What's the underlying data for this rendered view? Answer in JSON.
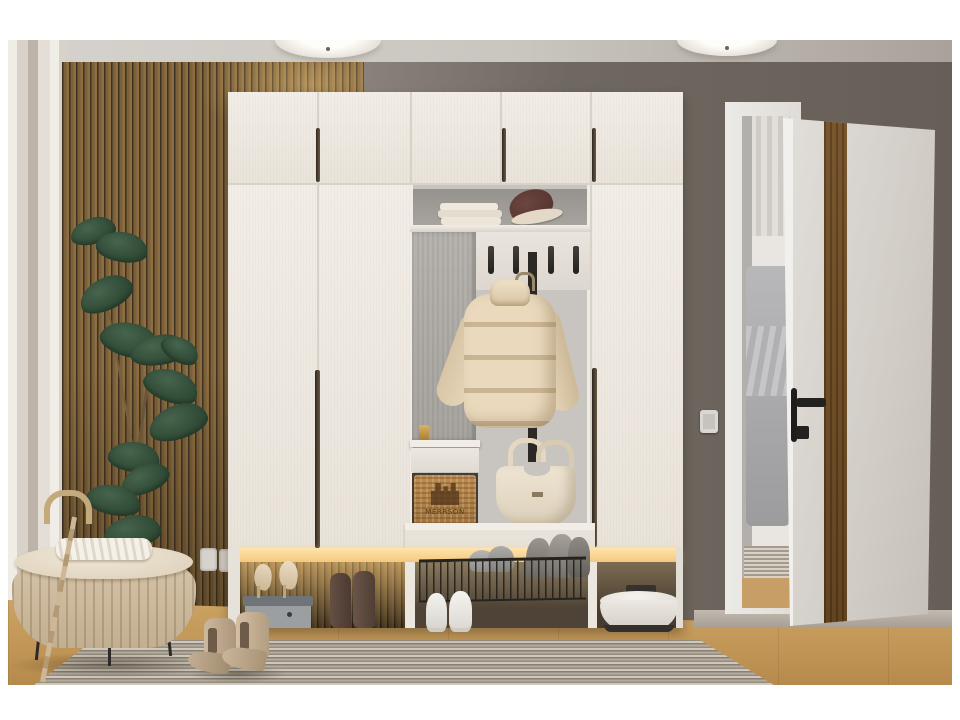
{
  "meta": {
    "title": "Hallway interior photo — white wardrobe entry unit",
    "scene_type": "interior product photograph",
    "border_color": "#ffffff"
  },
  "colors": {
    "ceiling": "#ccc8c1",
    "wall_taupe": "#6f6860",
    "curtain_wall": "#ddd6cd",
    "slat_wood": "#7c6039",
    "slat_gap": "#3e3223",
    "wardrobe_white": "#eee9e2",
    "niche_gray": "#c8c4bf",
    "led_glow": "#ffd998",
    "floor_wood": "#c29757",
    "rug": "#a59c8f",
    "door_white": "#d9d5d0",
    "door_wood_stripe": "#6f4e2d",
    "plant_green": "#33503a",
    "ottoman_beige": "#cdbaa0",
    "jacket_beige": "#e4d3b6",
    "tote_cream": "#e9dfcd",
    "basket_tan": "#b5854d",
    "vacuum_white": "#edeae4",
    "hardware_black": "#222120"
  },
  "items": {
    "lamps": "two flush ceiling lights",
    "plant": "rubber plant against wood slat wall",
    "ottoman": "beige pleated storage bench with throw",
    "umbrella": "tan cane umbrella",
    "wardrobe": "white 5-door hallway wardrobe with open niche",
    "shelf_contents": "folded towels and hat",
    "hooks": "4 black coat hooks",
    "jacket": "beige puffer jacket on hanger",
    "drawer": "white drawer with wicker basket",
    "basket": {
      "label": "MERRSON"
    },
    "tote": "cream tote bag",
    "shoes": "heels on shoebox, suede boots, sneakers, flats on wire rack, chelsea boots",
    "vacuum": "white robot vacuum",
    "door": "open white door with walnut stripe and black handle",
    "switch": "wall light switch",
    "socket": "double wall socket"
  }
}
